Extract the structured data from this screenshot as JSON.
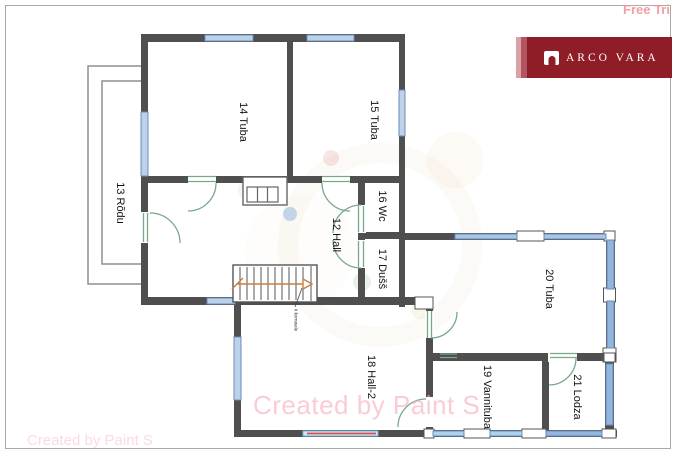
{
  "page": {
    "free_trial_text": "Free Tri",
    "watermark_center": "Created by Paint S",
    "watermark_bottom_left": "Created by Paint S"
  },
  "brand": {
    "name": "ARCO VARA",
    "banner_color": "#8f1d27",
    "stripe_light": "#d9a2a7",
    "stripe_mid": "#b25560"
  },
  "floor_plan": {
    "rooms": [
      {
        "label": "12 Hall"
      },
      {
        "label": "13 Rõdu"
      },
      {
        "label": "14 Tuba"
      },
      {
        "label": "15 Tuba"
      },
      {
        "label": "16 Wc"
      },
      {
        "label": "17 Dušš"
      },
      {
        "label": "18 Hall-2"
      },
      {
        "label": "19 Vannituba"
      },
      {
        "label": "20 Tuba"
      },
      {
        "label": "21 Lodza"
      }
    ],
    "stair_note": "II korrusele",
    "colors": {
      "wall": "#4f4f4f",
      "window_light": "#bdd2e8",
      "window_medium": "#aac6e4",
      "window_dark": "#92b6dd",
      "window_cyan": "#c9e9f8",
      "door_green": "#79a888",
      "arrow_orange": "#c87f3e",
      "red_line": "#e3474e",
      "watermark_pink": "#f6aebb"
    }
  }
}
